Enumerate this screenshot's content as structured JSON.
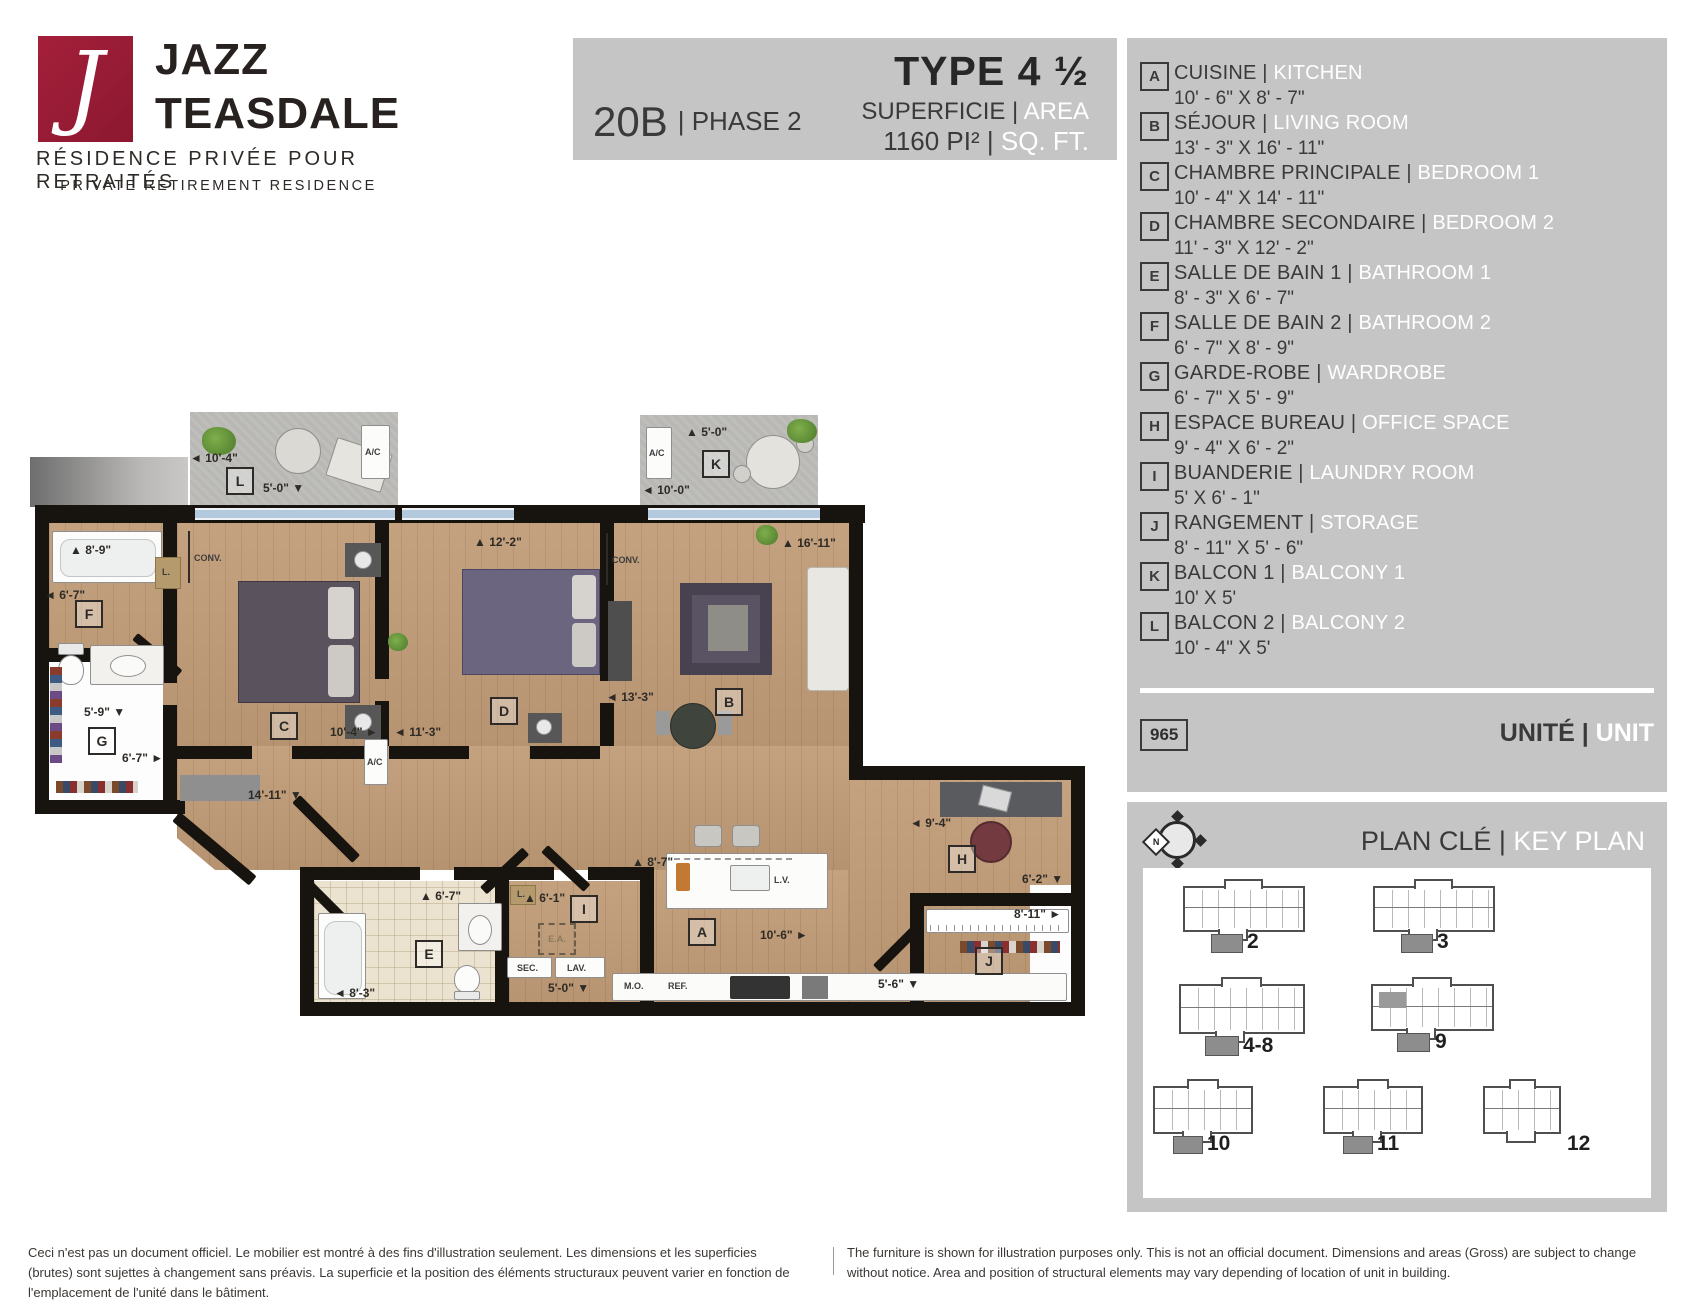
{
  "logo": {
    "glyph": "J",
    "brand_line1": "JAZZ",
    "brand_line2": "TEASDALE",
    "tagline_fr": "RÉSIDENCE PRIVÉE POUR RETRAITÉS",
    "tagline_en": "PRIVATE RETIREMENT RESIDENCE",
    "brand_color": "#9b1b35"
  },
  "header": {
    "unit_code": "20B",
    "phase": "| PHASE 2",
    "type_label": "TYPE 4 ½",
    "superficie_fr": "SUPERFICIE |",
    "superficie_en": "AREA",
    "area_value": "1160 PI² |",
    "area_unit": "SQ. FT."
  },
  "legend": {
    "rooms": [
      {
        "letter": "A",
        "name_fr": "CUISINE |",
        "name_en": "KITCHEN",
        "dims": "10' - 6\" X 8' - 7\""
      },
      {
        "letter": "B",
        "name_fr": "SÉJOUR |",
        "name_en": "LIVING ROOM",
        "dims": "13' - 3\" X 16' - 11\""
      },
      {
        "letter": "C",
        "name_fr": "CHAMBRE PRINCIPALE |",
        "name_en": "BEDROOM 1",
        "dims": "10' - 4\" X 14' - 11\""
      },
      {
        "letter": "D",
        "name_fr": "CHAMBRE SECONDAIRE |",
        "name_en": "BEDROOM 2",
        "dims": "11' - 3\" X 12' - 2\""
      },
      {
        "letter": "E",
        "name_fr": "SALLE DE BAIN 1 |",
        "name_en": "BATHROOM 1",
        "dims": "8' - 3\" X 6' - 7\""
      },
      {
        "letter": "F",
        "name_fr": "SALLE DE BAIN 2 |",
        "name_en": "BATHROOM 2",
        "dims": "6' - 7\" X 8' - 9\""
      },
      {
        "letter": "G",
        "name_fr": "GARDE-ROBE |",
        "name_en": "WARDROBE",
        "dims": "6' - 7\" X 5' - 9\""
      },
      {
        "letter": "H",
        "name_fr": "ESPACE BUREAU |",
        "name_en": "OFFICE SPACE",
        "dims": "9' - 4\" X 6' - 2\""
      },
      {
        "letter": "I",
        "name_fr": "BUANDERIE |",
        "name_en": "LAUNDRY ROOM",
        "dims": "5' X 6' - 1\""
      },
      {
        "letter": "J",
        "name_fr": "RANGEMENT |",
        "name_en": "STORAGE",
        "dims": "8' - 11\" X 5' - 6\""
      },
      {
        "letter": "K",
        "name_fr": "BALCON 1 |",
        "name_en": "BALCONY 1",
        "dims": "10' X 5'"
      },
      {
        "letter": "L",
        "name_fr": "BALCON 2 |",
        "name_en": "BALCONY 2",
        "dims": "10' - 4\" X 5'"
      }
    ]
  },
  "unit_info": {
    "number": "965",
    "label_fr": "UNITÉ |",
    "label_en": "UNIT"
  },
  "key_plan": {
    "title_fr": "PLAN CLÉ |",
    "title_en": "KEY PLAN",
    "compass_n": "N",
    "floors": [
      "2",
      "3",
      "4-8",
      "9",
      "10",
      "11",
      "12"
    ]
  },
  "floor_plan": {
    "texts": {
      "ac": "A/C",
      "conv": "CONV.",
      "ea": "E.A.",
      "sec": "SEC.",
      "lav": "LAV.",
      "mo": "M.O.",
      "ref": "REF.",
      "lv": "L.V.",
      "linen": "L."
    },
    "dims": {
      "balcony_l_width": "◄ 10'-4\"",
      "balcony_l_depth": "5'-0\" ▼",
      "balcony_k_depth": "▲ 5'-0\"",
      "balcony_k_width": "◄ 10'-0\"",
      "bath_f_width": "▲ 8'-9\"",
      "bath_f_depth": "◄ 6'-7\"",
      "wardrobe_width": "5'-9\" ▼",
      "wardrobe_depth": "6'-7\" ►",
      "bedroom1_length": "14'-11\" ▼",
      "bedroom1_width": "10'-4\" ►",
      "bedroom2_width": "◄ 11'-3\"",
      "bedroom2_top": "▲ 12'-2\"",
      "living_width": "◄ 13'-3\"",
      "living_length": "▲ 16'-11\"",
      "office_width": "◄ 9'-4\"",
      "storage_width": "6'-2\" ▼",
      "storage_length": "8'-11\" ►",
      "storage_bottom": "5'-6\" ▼",
      "bath_e_depth": "▲ 6'-7\"",
      "bath_e_width": "◄ 8'-3\"",
      "laundry_depth": "▲ 6'-1\"",
      "laundry_width": "5'-0\" ▼",
      "kitchen_depth": "▲ 8'-7\"",
      "kitchen_width": "10'-6\" ►"
    }
  },
  "footer": {
    "disclaimer_fr": "Ceci n'est pas un document officiel. Le mobilier est montré à des fins d'illustration seulement. Les dimensions et les superficies (brutes) sont sujettes à changement sans préavis. La superficie et la position des éléments structuraux peuvent varier en fonction de l'emplacement de l'unité dans le bâtiment.",
    "disclaimer_en": "The furniture is shown for illustration purposes only. This is not an official document. Dimensions and areas (Gross) are subject to change without notice. Area and position of structural elements may vary depending of location of unit in building."
  }
}
